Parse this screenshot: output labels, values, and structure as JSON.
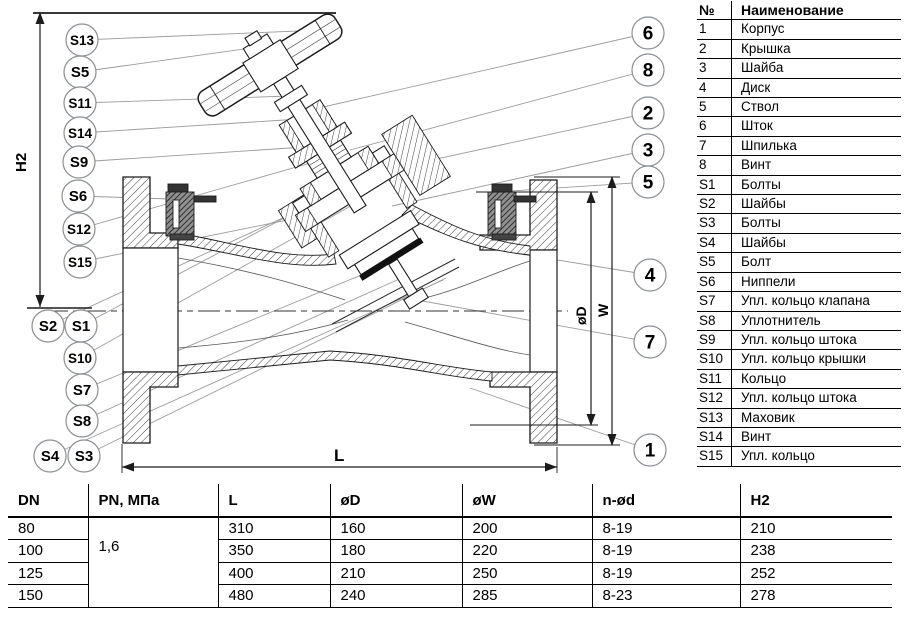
{
  "drawing": {
    "labels": {
      "h2": "H2",
      "l": "L",
      "od": "øD",
      "w": "W"
    },
    "callouts": [
      {
        "id": "S13",
        "label": "S13",
        "cx": 82,
        "cy": 40,
        "tx": 322,
        "ty": 30
      },
      {
        "id": "S5",
        "label": "S5",
        "cx": 80,
        "cy": 72,
        "tx": 258,
        "ty": 47
      },
      {
        "id": "S11",
        "label": "S11",
        "cx": 80,
        "cy": 103,
        "tx": 290,
        "ty": 96
      },
      {
        "id": "S14",
        "label": "S14",
        "cx": 80,
        "cy": 133,
        "tx": 300,
        "ty": 119
      },
      {
        "id": "S9",
        "label": "S9",
        "cx": 79,
        "cy": 162,
        "tx": 320,
        "ty": 146
      },
      {
        "id": "S6",
        "label": "S6",
        "cx": 78,
        "cy": 196,
        "tx": 170,
        "ty": 199
      },
      {
        "id": "S12",
        "label": "S12",
        "cx": 79,
        "cy": 229,
        "tx": 328,
        "ty": 158
      },
      {
        "id": "S15",
        "label": "S15",
        "cx": 80,
        "cy": 262,
        "tx": 327,
        "ty": 212
      },
      {
        "id": "S2",
        "label": "S2",
        "cx": 48,
        "cy": 326,
        "tx": 300,
        "ty": 210
      },
      {
        "id": "S1",
        "label": "S1",
        "cx": 81,
        "cy": 326,
        "tx": 303,
        "ty": 208
      },
      {
        "id": "S10",
        "label": "S10",
        "cx": 80,
        "cy": 358,
        "tx": 356,
        "ty": 203
      },
      {
        "id": "S7",
        "label": "S7",
        "cx": 82,
        "cy": 390,
        "tx": 388,
        "ty": 264
      },
      {
        "id": "S8",
        "label": "S8",
        "cx": 82,
        "cy": 421,
        "tx": 406,
        "ty": 276
      },
      {
        "id": "S4",
        "label": "S4",
        "cx": 50,
        "cy": 456,
        "tx": 443,
        "ty": 280
      },
      {
        "id": "S3",
        "label": "S3",
        "cx": 84,
        "cy": 456,
        "tx": 446,
        "ty": 278
      },
      {
        "id": "6",
        "label": "6",
        "cx": 648,
        "cy": 33,
        "tx": 310,
        "ty": 110
      },
      {
        "id": "8",
        "label": "8",
        "cx": 648,
        "cy": 70,
        "tx": 350,
        "ty": 150
      },
      {
        "id": "2",
        "label": "2",
        "cx": 648,
        "cy": 113,
        "tx": 340,
        "ty": 180
      },
      {
        "id": "3",
        "label": "3",
        "cx": 648,
        "cy": 150,
        "tx": 392,
        "ty": 206
      },
      {
        "id": "5",
        "label": "5",
        "cx": 648,
        "cy": 182,
        "tx": 496,
        "ty": 192
      },
      {
        "id": "4",
        "label": "4",
        "cx": 650,
        "cy": 275,
        "tx": 508,
        "ty": 252
      },
      {
        "id": "7",
        "label": "7",
        "cx": 650,
        "cy": 342,
        "tx": 417,
        "ty": 300
      },
      {
        "id": "1",
        "label": "1",
        "cx": 650,
        "cy": 450,
        "tx": 470,
        "ty": 388
      }
    ]
  },
  "parts_table": {
    "headers": [
      "№",
      "Наименование"
    ],
    "rows": [
      [
        "1",
        "Корпус"
      ],
      [
        "2",
        "Крышка"
      ],
      [
        "3",
        "Шайба"
      ],
      [
        "4",
        "Диск"
      ],
      [
        "5",
        "Ствол"
      ],
      [
        "6",
        "Шток"
      ],
      [
        "7",
        "Шпилька"
      ],
      [
        "8",
        "Винт"
      ],
      [
        "S1",
        "Болты"
      ],
      [
        "S2",
        "Шайбы"
      ],
      [
        "S3",
        "Болты"
      ],
      [
        "S4",
        "Шайбы"
      ],
      [
        "S5",
        "Болт"
      ],
      [
        "S6",
        "Ниппели"
      ],
      [
        "S7",
        "Упл. кольцо клапана"
      ],
      [
        "S8",
        "Уплотнитель"
      ],
      [
        "S9",
        "Упл. кольцо штока"
      ],
      [
        "S10",
        "Упл. кольцо крышки"
      ],
      [
        "S11",
        "Кольцо"
      ],
      [
        "S12",
        "Упл. кольцо штока"
      ],
      [
        "S13",
        "Маховик"
      ],
      [
        "S14",
        "Винт"
      ],
      [
        "S15",
        "Упл. кольцо"
      ]
    ]
  },
  "dims_table": {
    "headers": [
      "DN",
      "PN, МПа",
      "L",
      "øD",
      "øW",
      "n-ød",
      "H2"
    ],
    "pn_value": "1,6",
    "rows": [
      [
        "80",
        "310",
        "160",
        "200",
        "8-19",
        "210"
      ],
      [
        "100",
        "350",
        "180",
        "220",
        "8-19",
        "238"
      ],
      [
        "125",
        "400",
        "210",
        "250",
        "8-19",
        "252"
      ],
      [
        "150",
        "480",
        "240",
        "285",
        "8-23",
        "278"
      ]
    ]
  }
}
